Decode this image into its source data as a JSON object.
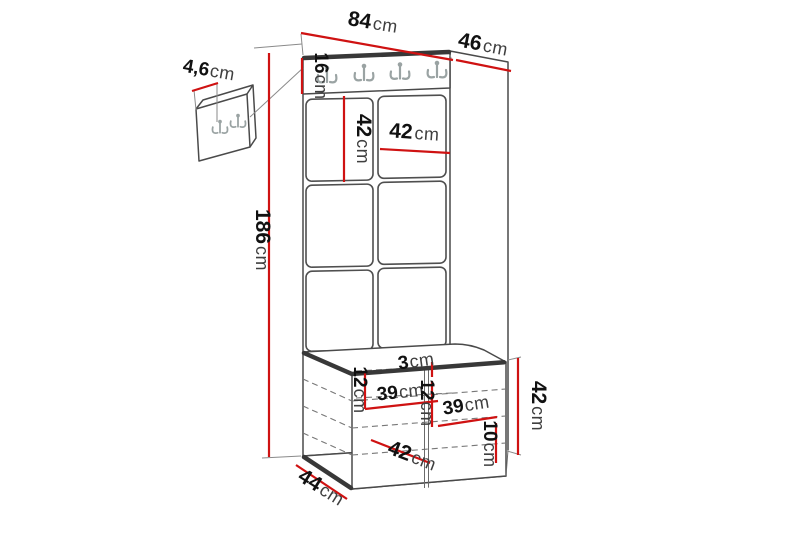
{
  "figure_type": "furniture-dimension-diagram",
  "product": "hallway coat-rack panel with hook rail, upholstered wall tiles and storage bench",
  "unit": "cm",
  "colors": {
    "dimension_line": "#cf1212",
    "outline": "#4a4a4a",
    "dark_edge": "#383838",
    "hooks": "#9aa3a3",
    "number_text": "#111111",
    "unit_text": "#3f3f3f",
    "background": "#ffffff"
  },
  "dims": {
    "total_width": "84",
    "top_depth": "46",
    "total_height": "186",
    "rail_height": "16",
    "tile_height": "42",
    "tile_width": "42",
    "wall_panel_thickness": "4,6",
    "cushion_gap": "3",
    "left_shelf_height": "12",
    "left_shelf_width": "39",
    "right_shelf_height": "12",
    "right_shelf_width": "39",
    "bench_inner_depth": "42",
    "bottom_shelf_height": "10",
    "bench_height": "42",
    "bench_depth": "44"
  }
}
